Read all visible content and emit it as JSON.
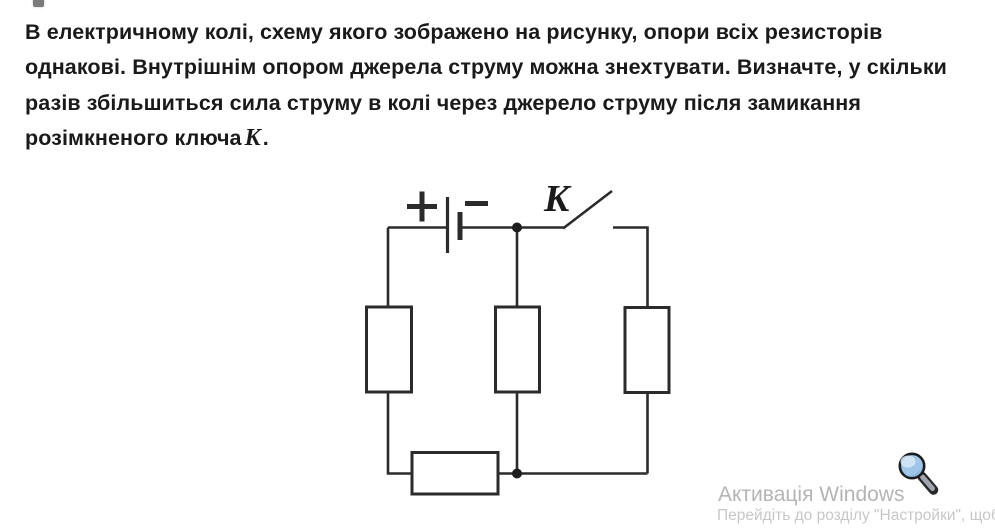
{
  "problem": {
    "lines": [
      "В електричному колі, схему якого зображено на рисунку, опори всіх резисторів",
      "однакові. Внутрішнім опором джерела струму можна знехтувати. Визначте, у скільки",
      "разів збільшиться сила струму в колі через джерело струму після замикання"
    ],
    "last_line_prefix": "розімкненого ключа",
    "key_symbol": "K",
    "last_line_suffix": "."
  },
  "circuit": {
    "switch_label": "K",
    "battery_plus": "+",
    "battery_minus": "−",
    "line_color": "#2b2b2b",
    "resistor_count": 4,
    "type": "circuit-diagram"
  },
  "watermark": {
    "title": "Активація Windows",
    "subtitle": "Перейдіть до розділу \"Настройки\", щоб",
    "title_color": "#b4b4b4",
    "subtitle_color": "#c7c7c7"
  },
  "colors": {
    "text": "#1a1a1a",
    "background": "#ffffff"
  }
}
